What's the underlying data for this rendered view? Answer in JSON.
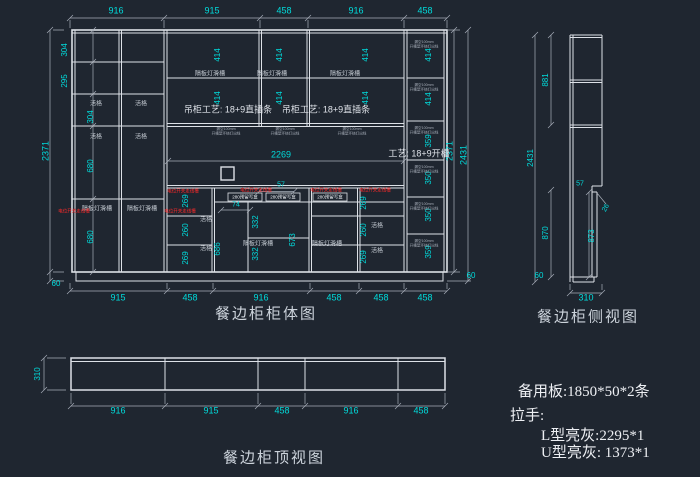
{
  "colors": {
    "background": "#1f2630",
    "line": "#dde1e7",
    "dim_text": "#00dcdc",
    "red_note": "#ff2a2a",
    "title_text": "#ccd3db"
  },
  "elevation": {
    "title": "餐边柜柜体图",
    "top_dims": [
      "916",
      "915",
      "458",
      "916",
      "458"
    ],
    "bottom_dims": [
      "915",
      "458",
      "916",
      "458",
      "458",
      "458"
    ],
    "height_inner": "2371",
    "height_overall": "2431",
    "toe": "60",
    "left_rows": [
      "304",
      "295",
      "304",
      "680",
      "680"
    ],
    "hang_dim": "414",
    "right_col": [
      "414",
      "414",
      "359",
      "350",
      "350",
      "359"
    ],
    "small_col": [
      "269",
      "260",
      "269"
    ],
    "open_width": "2269",
    "mid": {
      "a": "332",
      "b": "332",
      "left_h": "686",
      "right_h": "673",
      "top_h": "57",
      "slot_h": "74"
    },
    "labels": {
      "hang_process": "吊柜工艺: 18+9直插条",
      "process": "工艺: 18+9开槽",
      "shelf_light": "隔板灯滑槽",
      "movable": "活格",
      "outlet": "电位开关走线槽",
      "junction_box": "280预留写盒",
      "tiny_line1": "漏空100mm",
      "tiny_line2": "开槽型环绕灯出线"
    }
  },
  "side": {
    "title": "餐边柜侧视图",
    "upper": "881",
    "overall": "2431",
    "top_edge": "57",
    "nose": "26",
    "lower": "870",
    "inner": "873",
    "toe": "60",
    "depth": "310"
  },
  "top": {
    "title": "餐边柜顶视图",
    "dims": [
      "916",
      "915",
      "458",
      "916",
      "458"
    ],
    "depth": "310"
  },
  "notes": {
    "spare": "备用板:1850*50*2条",
    "handles": "拉手:",
    "l_type": "L型亮灰:2295*1",
    "u_type": "U型亮灰:  1373*1"
  }
}
